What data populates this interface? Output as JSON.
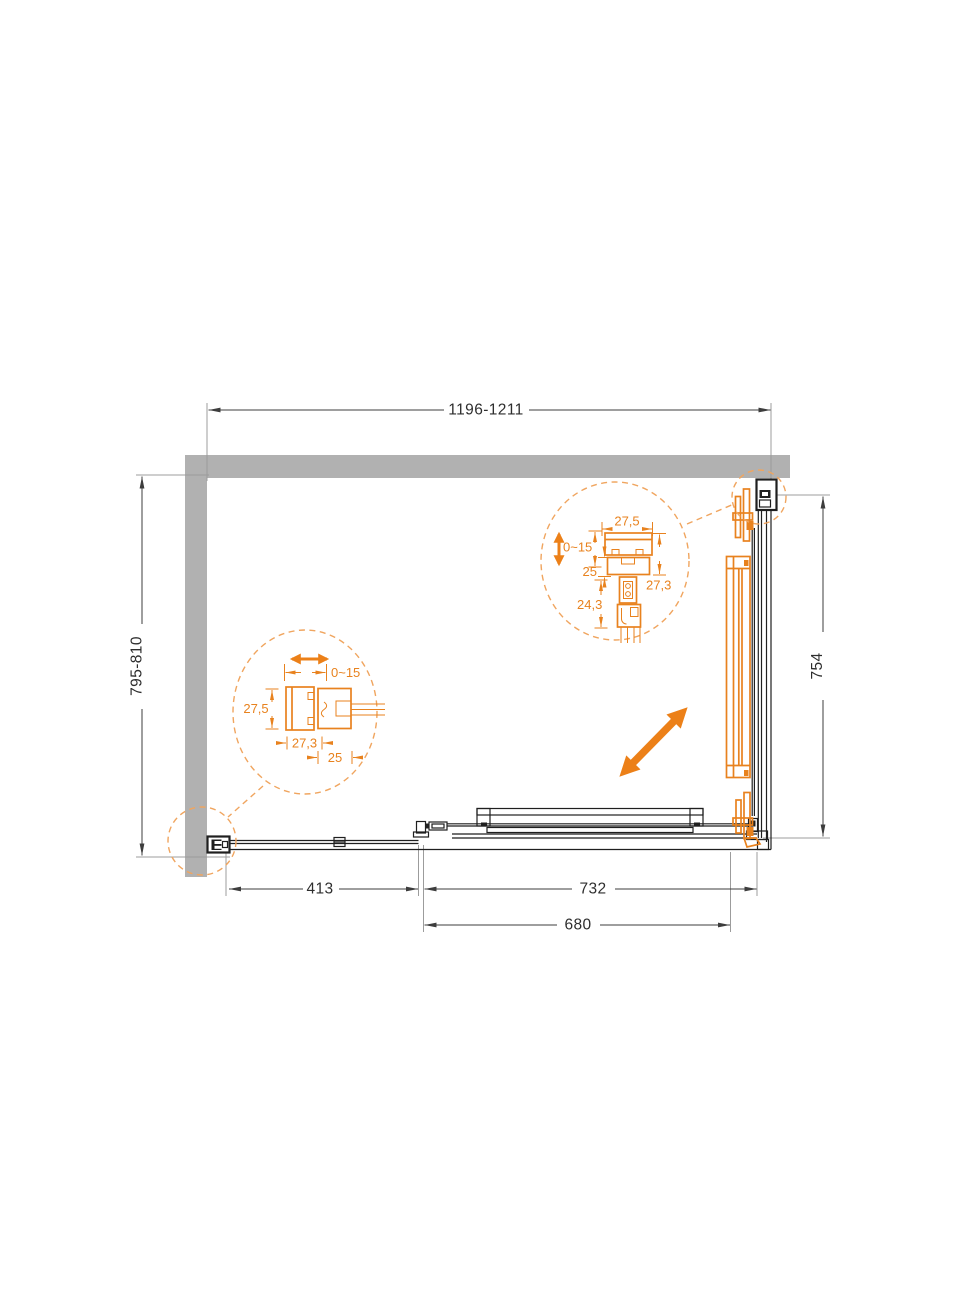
{
  "drawing": {
    "type": "shower-enclosure-plan-top-view",
    "colors": {
      "accent_orange": "#E8821E",
      "arrow_orange": "#EC8018",
      "bubble_dash_orange": "#F0A55F",
      "wall_gray": "#B1B1B1",
      "line_black": "#1F1F1F"
    },
    "dims": {
      "width_top": "1196-1211",
      "depth_left": "795-810",
      "door_side_right": "754",
      "fixed_panel_bottom": "413",
      "door_front_bottom": "732",
      "opening_bottom": "680"
    },
    "detail_left": {
      "adjustment": "0~15",
      "profile_depth": "27,5",
      "profile_width": "27,3",
      "glass_insert": "25"
    },
    "detail_top_right": {
      "profile_width": "27,5",
      "adjustment": "0~15",
      "glass_insert": "25",
      "hanger_offset": "24,3",
      "profile_depth": "27,3"
    }
  }
}
